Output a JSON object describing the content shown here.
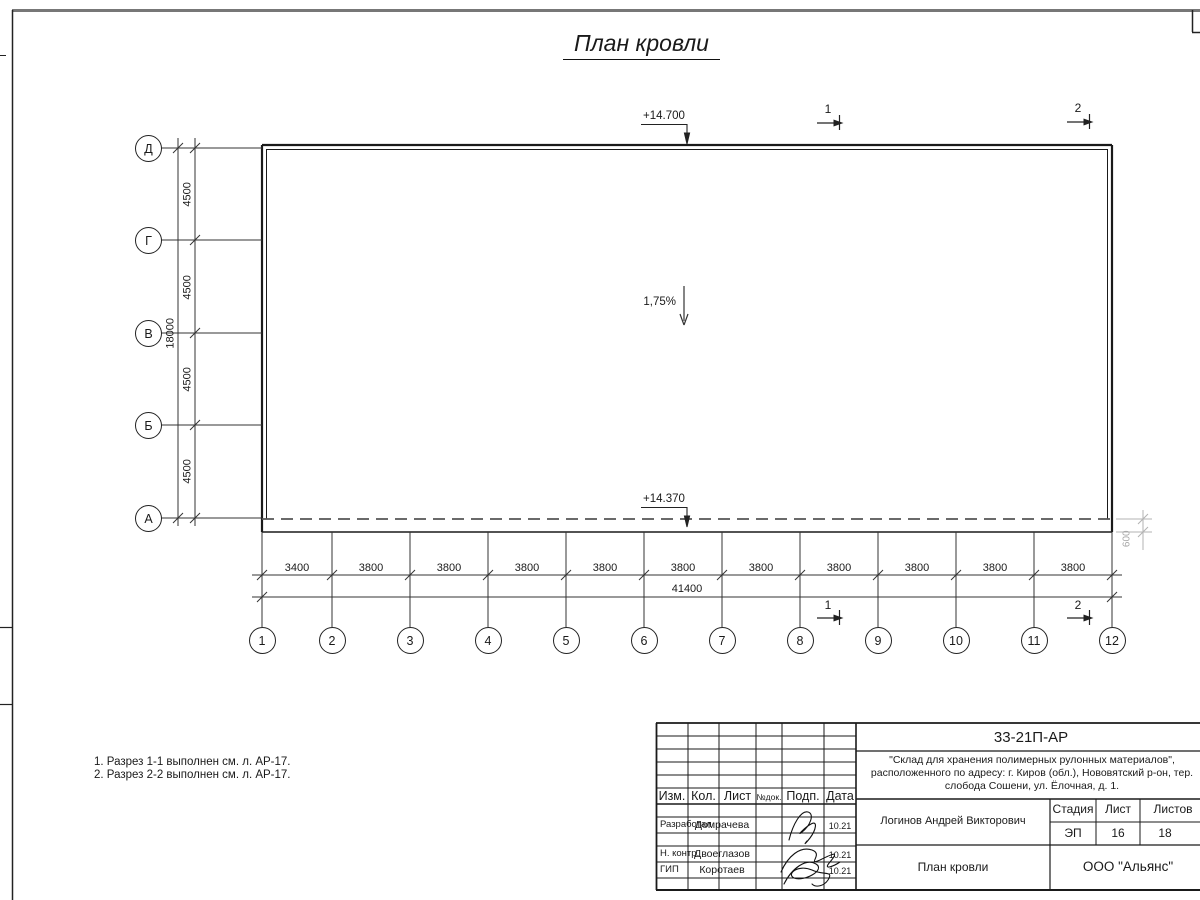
{
  "title": "План кровли",
  "plan": {
    "grid": {
      "rows": [
        "Д",
        "Г",
        "В",
        "Б",
        "А"
      ],
      "cols": [
        "1",
        "2",
        "3",
        "4",
        "5",
        "6",
        "7",
        "8",
        "9",
        "10",
        "11",
        "12"
      ],
      "row_dims": [
        "4500",
        "4500",
        "4500",
        "4500"
      ],
      "row_total": "18000",
      "col_dims": [
        "3400",
        "3800",
        "3800",
        "3800",
        "3800",
        "3800",
        "3800",
        "3800",
        "3800",
        "3800",
        "3800"
      ],
      "col_total": "41400"
    },
    "annotations": {
      "elevation_top": "+14.700",
      "elevation_eaves": "+14.370",
      "slope": "1,75%",
      "overhang": "600",
      "section_1": "1",
      "section_2": "2"
    }
  },
  "notes": [
    "1. Разрез 1-1 выполнен см. л. АР-17.",
    "2. Разрез 2-2 выполнен см. л. АР-17."
  ],
  "titleblock": {
    "doc_number": "33-21П-АР",
    "project_lines": [
      "\"Склад для хранения полимерных рулонных материалов\",",
      "расположенного по адресу: г. Киров (обл.), Нововятский р-он, тер.",
      "слобода Сошени, ул. Ёлочная, д. 1."
    ],
    "columns": [
      "Изм.",
      "Кол.",
      "Лист",
      "№док.",
      "Подп.",
      "Дата"
    ],
    "rows": [
      {
        "role": "Разработал",
        "name": "Домрачева",
        "date": "10.21"
      },
      {
        "role": "Н. контр.",
        "name": "Двоеглазов",
        "date": "10.21"
      },
      {
        "role": "ГИП",
        "name": "Коротаев",
        "date": "10.21"
      }
    ],
    "approver": "Логинов Андрей Викторович",
    "stage_label": "Стадия",
    "sheet_label": "Лист",
    "sheets_label": "Листов",
    "stage": "ЭП",
    "sheet": "16",
    "sheets": "18",
    "drawing_title": "План кровли",
    "company": "ООО \"Альянс\""
  }
}
